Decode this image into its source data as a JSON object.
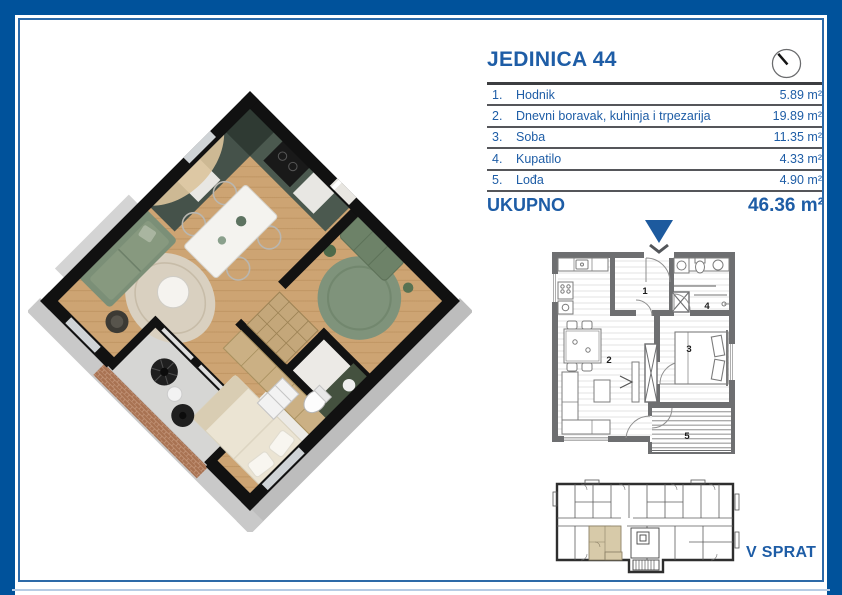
{
  "unit": {
    "title": "JEDINICA 44",
    "rooms": [
      {
        "num": "1.",
        "name": "Hodnik",
        "area": "5.89 m²"
      },
      {
        "num": "2.",
        "name": "Dnevni boravak, kuhinja i trpezarija",
        "area": "19.89 m²"
      },
      {
        "num": "3.",
        "name": "Soba",
        "area": "11.35 m²"
      },
      {
        "num": "4.",
        "name": "Kupatilo",
        "area": "4.33 m²"
      },
      {
        "num": "5.",
        "name": "Lođa",
        "area": "4.90 m²"
      }
    ],
    "total_label": "UKUPNO",
    "total_area": "46.36 m²"
  },
  "floor": {
    "label": "V SPRAT"
  },
  "plan2d": {
    "room_labels": {
      "r1": "1",
      "r2": "2",
      "r3": "3",
      "r4": "4",
      "r5": "5"
    }
  },
  "icons": {
    "compass": "circle-with-needle north indicator",
    "entrance": "solid down-triangle entrance marker"
  },
  "colors": {
    "frame": "#00529b",
    "frame_inner_line": "#2d6aa8",
    "frame_bottom_line": "#b7cce4",
    "accent_text": "#1e5da6",
    "row_divider": "#55565a",
    "plan_wall": "#6e6f71",
    "arrow": "#1d5a9e",
    "unit_highlight": "#d7caa9",
    "wood_floor": "#cda473",
    "kitchen_green": "#45524a",
    "sofa_green": "#7b8f77",
    "bed_cream": "#ebe4d3",
    "brick_railing": "#a87252"
  }
}
